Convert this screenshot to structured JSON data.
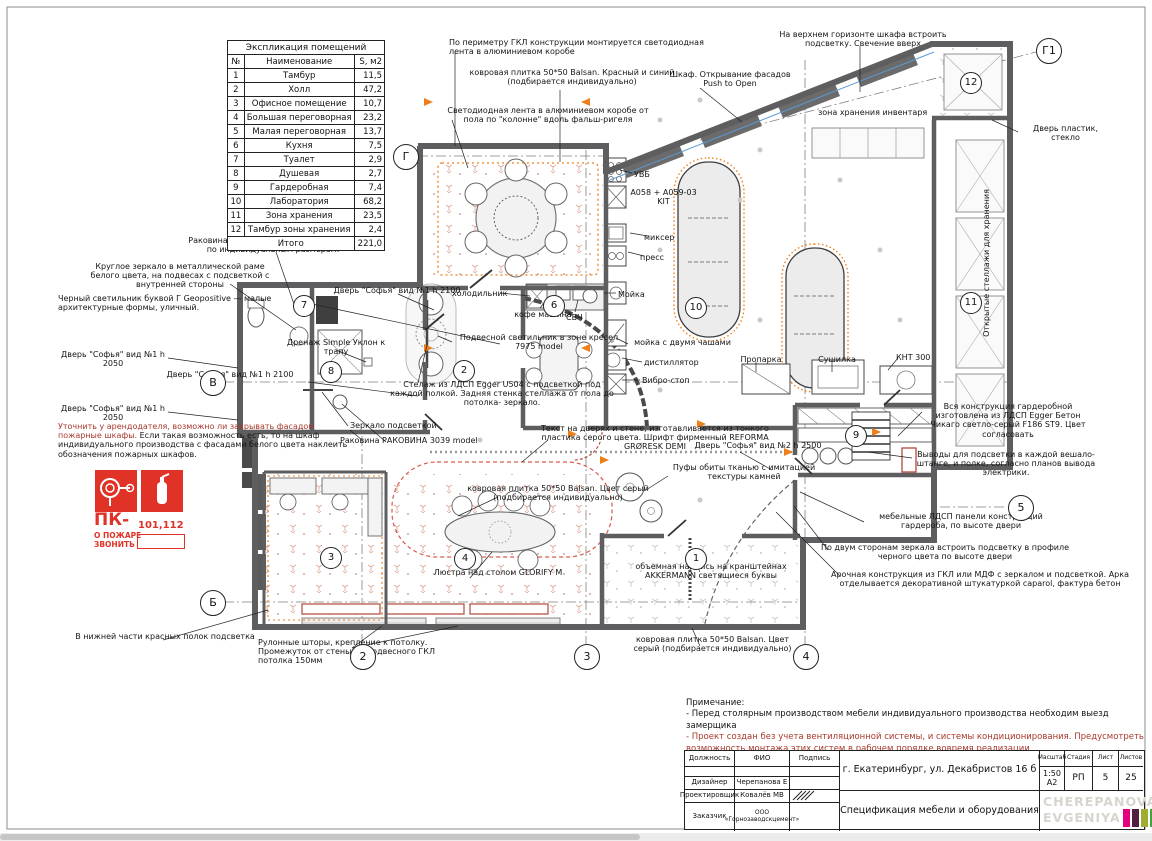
{
  "legend": {
    "title": "Экспликация помещений",
    "col_num": "№",
    "col_name": "Наименование",
    "col_area": "S, м2",
    "rows": [
      {
        "n": "1",
        "name": "Тамбур",
        "area": "11,5"
      },
      {
        "n": "2",
        "name": "Холл",
        "area": "47,2"
      },
      {
        "n": "3",
        "name": "Офисное помещение",
        "area": "10,7"
      },
      {
        "n": "4",
        "name": "Большая переговорная",
        "area": "23,2"
      },
      {
        "n": "5",
        "name": "Малая переговорная",
        "area": "13,7"
      },
      {
        "n": "6",
        "name": "Кухня",
        "area": "7,5"
      },
      {
        "n": "7",
        "name": "Туалет",
        "area": "2,9"
      },
      {
        "n": "8",
        "name": "Душевая",
        "area": "2,7"
      },
      {
        "n": "9",
        "name": "Гардеробная",
        "area": "7,4"
      },
      {
        "n": "10",
        "name": "Лаборатория",
        "area": "68,2"
      },
      {
        "n": "11",
        "name": "Зона хранения",
        "area": "23,5"
      },
      {
        "n": "12",
        "name": "Тамбур зоны хранения",
        "area": "2,4"
      }
    ],
    "total_label": "Итого",
    "total_value": "221,0"
  },
  "ann": {
    "a1": "По периметру ГКЛ конструкции монтируется светодиодная лента в алюминиевом коробе",
    "a2": "ковровая плитка 50*50 Balsan. Красный и синий (подбирается индивидуально)",
    "a3": "Светодиодная лента в алюминиевом коробе от пола по \"колонне\" вдоль фальш-ригеля",
    "a4": "Шкаф. Открывание фасадов Push to Open",
    "a5": "На верхнем горизонте шкафа встроить подсветку. Свечение вверх",
    "a6": "зона хранения инвентаря",
    "a7": "Дверь пластик, стекло",
    "a8": "Раковина ПетроБетон, изготавливается по индивидуальным размерам.",
    "a9": "Круглое зеркало в металлической раме белого цвета, на подвесах с подсветкой с внутренней стороны",
    "a10": "Черный светильник буквой Г Geopositive — малые архитектурные формы, уличный.",
    "a11": "Дренаж Simple Уклон к трапу",
    "a12": "Дверь \"Софья\" вид №1 h 2050",
    "a13": "Дверь \"Софья\" вид №1 h 2100",
    "a14": "Дверь \"Софья\" вид №1 h 2050",
    "a15_red": "Уточнить у арендодателя, возможно ли закрывать фасадом пожарные шкафы.",
    "a15_rest": " Если такая возможность есть, то на шкаф индивидуального производства с фасадами белого цвета наклеить обозначения пожарных шкафов.",
    "a16": "В нижней части красных полок подсветка",
    "a17": "Дверь \"Софья\" вид №1 h 2100",
    "a18": "холодильник",
    "a19": "Подвесной светильник в зоне кресел 7975 model",
    "a20": "Стелаж из ЛДСП Egger U504 с подсветкой под каждой полкой. Задняя стенка стеллажа от пола до потолка- зеркало.",
    "a21": "Зеркало подсветкой",
    "a22": "Раковина РАКОВИНА 3039 model",
    "a23": "Текст на дверях и стене, изготавливается из тонкого пластика серого цвета. Шрифт фирменный REFORMA GRØRESK DEMI",
    "a24": "ковровая плитка 50*50 Balsan. Цвет серый (подбирается индивидуально)",
    "a25": "Дверь \"Софья\" вид №2 h 2500",
    "a26": "Пуфы обиты тканью с имитацией текстуры камней",
    "a27": "кофе машина",
    "a28": "СВЧ",
    "a29": "Мойка",
    "a30": "мойка с двумя чашами",
    "a31": "дистиллятор",
    "a32": "Вибро-стоп",
    "a33": "Пропарка",
    "a34": "Сушилка",
    "a35": "КНТ 300",
    "a36": "УВБ",
    "a37": "A058 + A059-03 KIT",
    "a38": "миксер",
    "a39": "пресс",
    "a40": "Открытые стеллажи для хранения",
    "a41": "Вся конструкция гардеробной изготовлена из ЛДСП Egger Бетон Чикаго светло-серый F186 ST9. Цвет согласовать",
    "a42": "Выводы для подсветки в каждой вешало-штанге, и полке, согласно планов вывода электрики.",
    "a43": "мебельные ЛДСП панели конструкций гардероба, по высоте двери",
    "a44": "По двум сторонам зеркала встроить подсветку в профиле черного цвета по высоте двери",
    "a45": "Арочная конструкция из ГКЛ или МДФ с зеркалом и подсветкой. Арка отделывается декоративной штукатуркой caparol, фактура бетон",
    "a46": "объемная надпись на кранштейнах AKKERMANN светящиеся буквы",
    "a47": "Люстра над столом GLORIFY M",
    "a48": "ковровая плитка 50*50 Balsan. Цвет серый (подбирается индивидуально)",
    "a49": "Рулонные шторы, крепление к потолку. Промежуток от стены до подвесного ГКЛ потолка 150мм"
  },
  "axis": {
    "g": "Г",
    "v": "В",
    "b": "Б",
    "g1": "Г1",
    "c2": "2",
    "c3": "3",
    "c4": "4",
    "c5": "5"
  },
  "rooms": {
    "r1": "1",
    "r2": "2",
    "r3": "3",
    "r4": "4",
    "r6": "6",
    "r7": "7",
    "r8": "8",
    "r9": "9",
    "r10": "10",
    "r11": "11",
    "r12": "12"
  },
  "fire_sign": {
    "code": "ПК-",
    "numbers": "101,112",
    "line1": "О ПОЖАРЕ",
    "line2": "ЗВОНИТЬ"
  },
  "notes": {
    "title": "Примечание:",
    "line1": "- Перед столярным производством мебели индивидуального производства необходим выезд замерщика",
    "line2": "- Проект создан без учета вентиляционной системы, и системы кондиционирования. Предусмотреть возможность монтажа этих систем в рабочем порядке вовремя реализации."
  },
  "titleblock": {
    "col_role": "Должность",
    "col_fio": "ФИО",
    "col_sign": "Подпись",
    "people": [
      {
        "role": "Дизайнер",
        "name": "Черепанова Е"
      },
      {
        "role": "Проектировщик",
        "name": "Ковалёв МВ"
      },
      {
        "role": "Заказчик",
        "name": "ООО «Горнозаводскцемент»"
      }
    ],
    "address": "г. Екатеринбург, ул. Декабристов 16 б",
    "doc_title": "Спецификация мебели и оборудования",
    "scale_label": "Масштаб",
    "scale1": "1:50",
    "scale2": "А2",
    "stage_label": "Стадия",
    "stage": "РП",
    "sheet_label": "Лист",
    "sheet": "5",
    "sheets_label": "Листов",
    "sheets": "25",
    "logo_line1": "CHEREPANOVA",
    "logo_line2": "EVGENIYA",
    "logo_bars": [
      {
        "color": "#E6007E"
      },
      {
        "color": "#512040"
      },
      {
        "color": "#9FAE32"
      },
      {
        "color": "#44A638"
      },
      {
        "color": "#5C5566"
      },
      {
        "color": "#2FB6AD"
      }
    ]
  },
  "colors": {
    "sign_red": "#E03226",
    "note_red": "#A8382C",
    "accent_orange": "#EF7F1A",
    "dash_red": "#D9594C",
    "wall_gray": "#5E5E60",
    "logo_gray": "#D8D4CE"
  }
}
